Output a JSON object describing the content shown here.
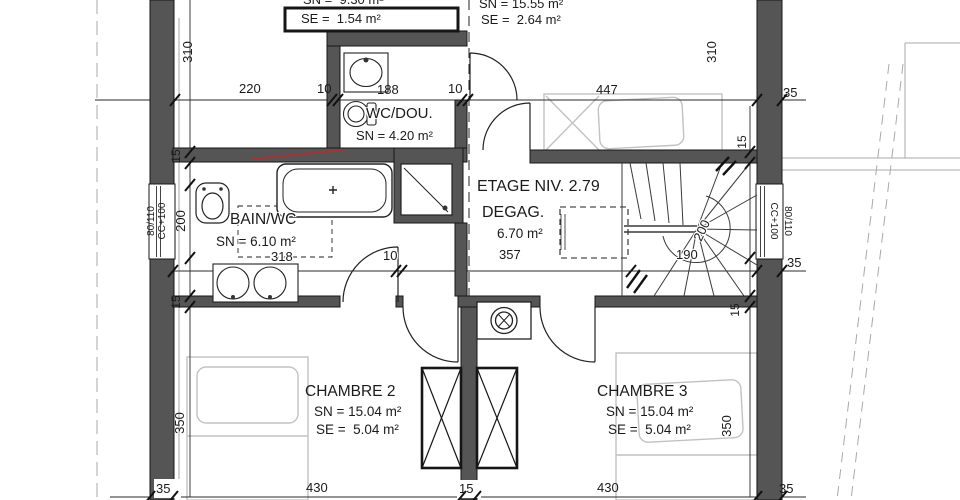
{
  "title_block": {
    "floor_level_label": "ETAGE NIV. 2.79"
  },
  "rooms": {
    "attic_left": {
      "sn": "SN =  9.30 m²",
      "se": "SE =  1.54 m²"
    },
    "bedroom_top": {
      "sn": "SN = 15.55 m²",
      "se": "SE =  2.64 m²"
    },
    "wc_shower": {
      "name": "WC/DOU.",
      "sn": "SN = 4.20 m²"
    },
    "bathroom": {
      "name": "BAIN/WC",
      "sn": "SN = 6.10 m²"
    },
    "landing": {
      "name": "DEGAG.",
      "area": "6.70 m²"
    },
    "bedroom2": {
      "name": "CHAMBRE 2",
      "sn": "SN = 15.04 m²",
      "se": "SE =  5.04 m²"
    },
    "bedroom3": {
      "name": "CHAMBRE 3",
      "sn": "SN = 15.04 m²",
      "se": "SE =  5.04 m²"
    }
  },
  "dimensions": {
    "top_row": [
      "220",
      "10",
      "188",
      "10",
      "447",
      "35"
    ],
    "middle_row": [
      "318",
      "10",
      "357",
      "190",
      "35"
    ],
    "bottom_row": [
      "35",
      "430",
      "15",
      "430",
      "35"
    ],
    "left_column": [
      "310",
      "15",
      "200",
      "15",
      "350"
    ],
    "right_column": [
      "310",
      "15",
      "15",
      "350"
    ],
    "stair_width": "200"
  },
  "windows": {
    "left": {
      "size": "80/110",
      "sill": "CC+100"
    },
    "right": {
      "size": "80/110",
      "sill": "CC+100"
    }
  },
  "colors": {
    "wall": "#555555",
    "line": "#1a1a1a",
    "furniture": "#c2c2c2",
    "accent_red": "#a23535",
    "background": "#ffffff"
  }
}
